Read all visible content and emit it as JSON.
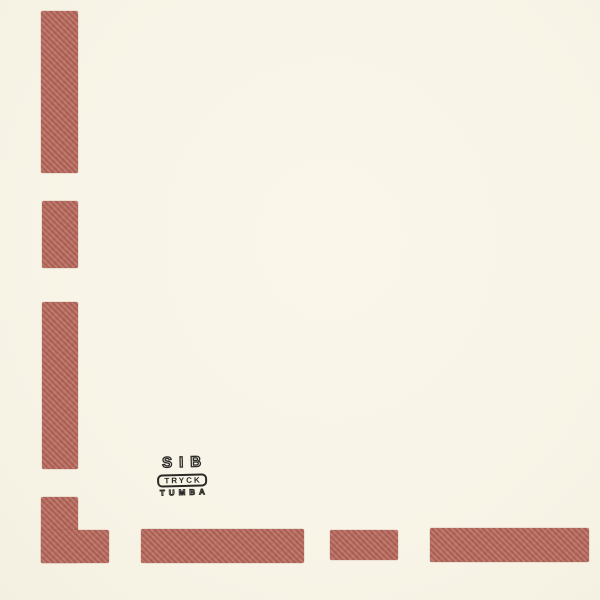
{
  "page": {
    "background_color": "#f8f4e8",
    "bar_color": "#b5695d",
    "ink_color": "#2b2a26"
  },
  "printer_mark": {
    "line1": "SIB",
    "line2": "TRYCK",
    "line3": "TUMBA"
  },
  "graphics": {
    "bars": [
      {
        "name": "left-dash-1",
        "x": 41,
        "y": 11,
        "w": 37,
        "h": 162
      },
      {
        "name": "left-dash-2",
        "x": 42,
        "y": 201,
        "w": 36,
        "h": 67
      },
      {
        "name": "left-dash-3",
        "x": 42,
        "y": 302,
        "w": 36,
        "h": 167
      },
      {
        "name": "corner-dash-vertical",
        "x": 41,
        "y": 497,
        "w": 37,
        "h": 66
      },
      {
        "name": "corner-dash-horizontal",
        "x": 41,
        "y": 530,
        "w": 68,
        "h": 33
      },
      {
        "name": "bottom-dash-1",
        "x": 141,
        "y": 529,
        "w": 163,
        "h": 34
      },
      {
        "name": "bottom-dash-2",
        "x": 330,
        "y": 530,
        "w": 68,
        "h": 30
      },
      {
        "name": "bottom-dash-3",
        "x": 430,
        "y": 528,
        "w": 159,
        "h": 34
      }
    ]
  }
}
